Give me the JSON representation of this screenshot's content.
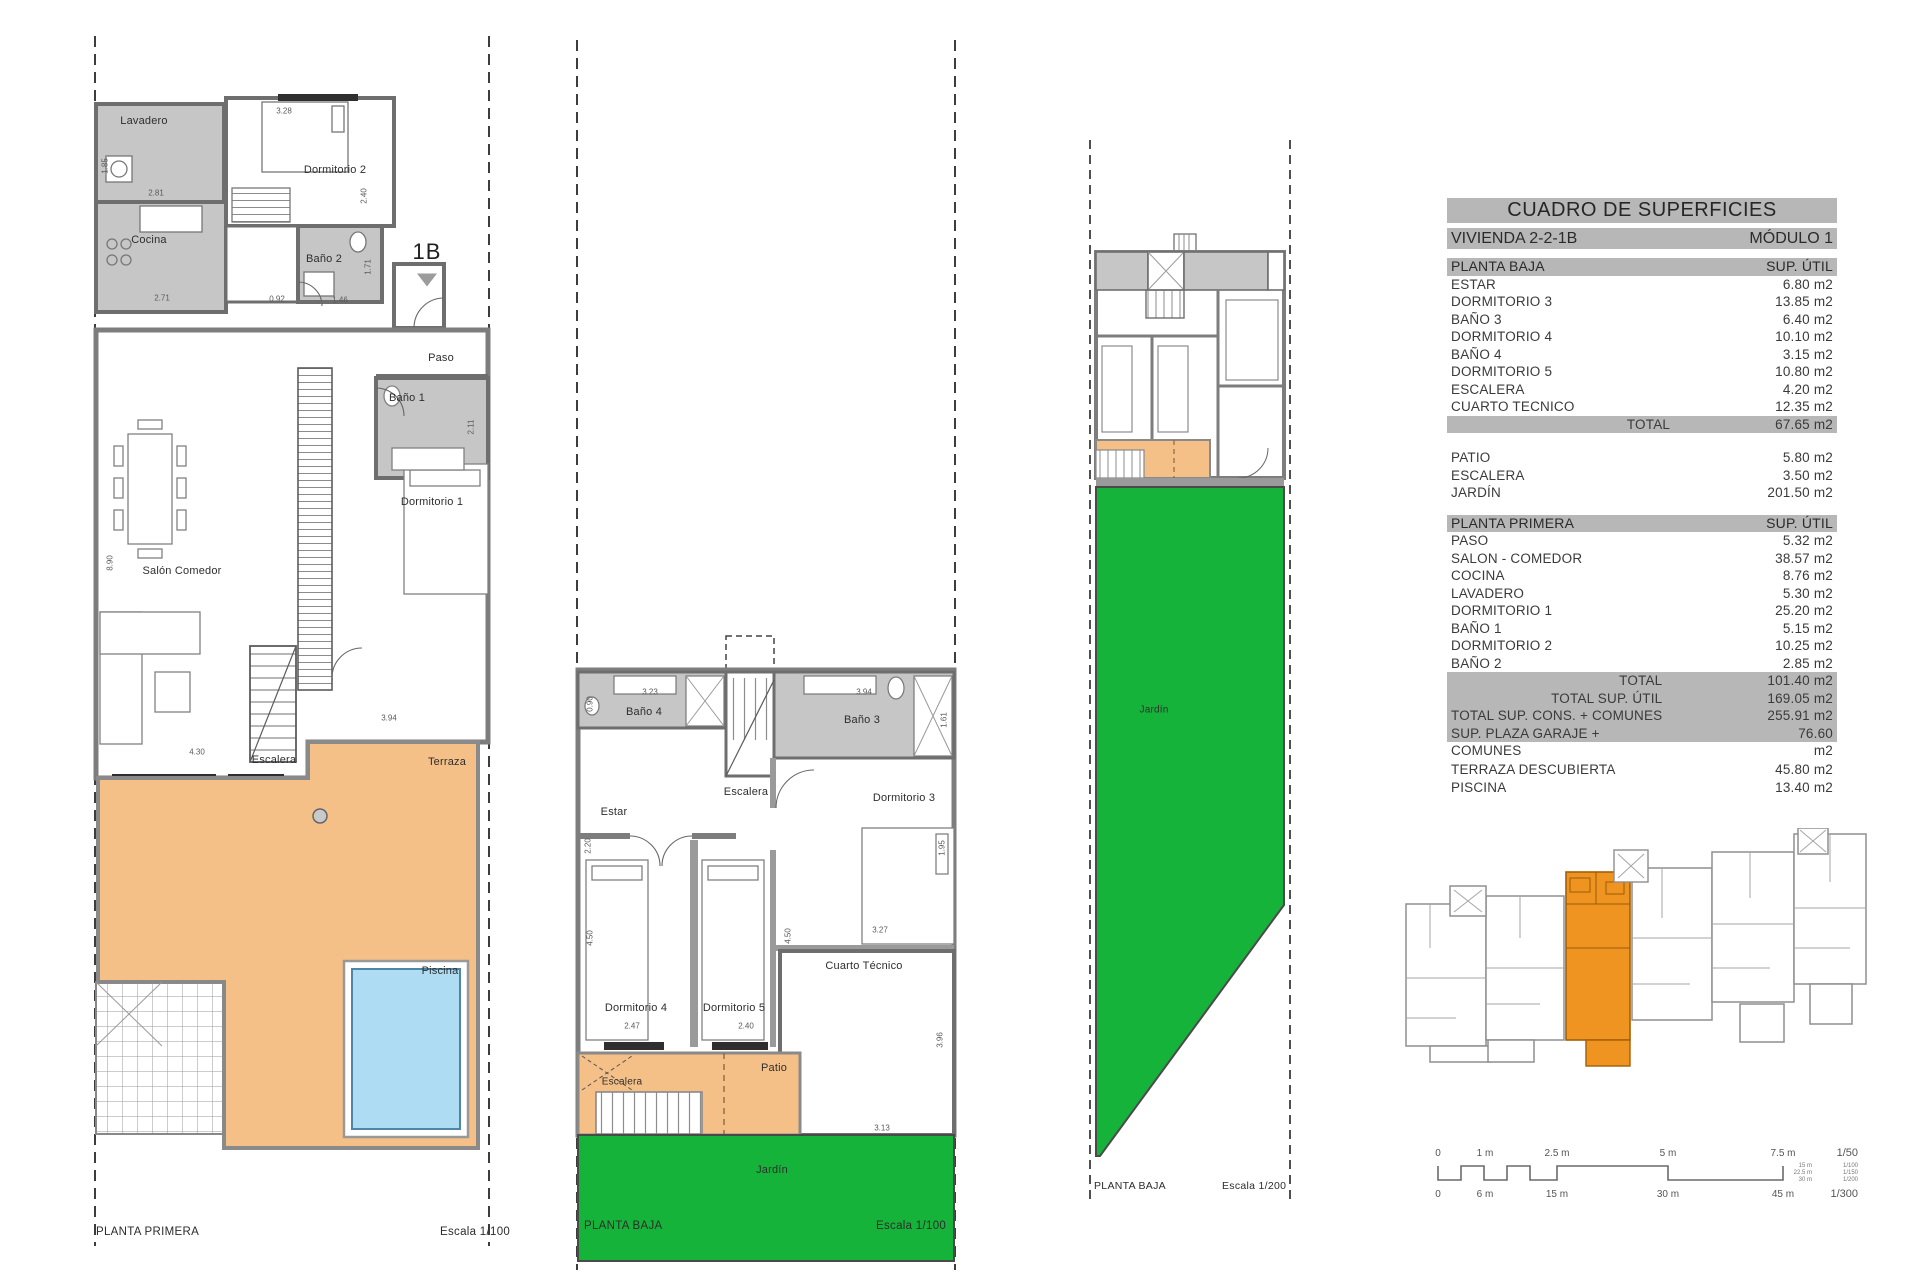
{
  "table": {
    "title": "CUADRO DE SUPERFICIES",
    "vivienda": "VIVIENDA 2-2-1B",
    "modulo": "MÓDULO 1",
    "planta_baja": {
      "header": "PLANTA BAJA",
      "sup_util": "SUP. ÚTIL",
      "rows": [
        {
          "label": "ESTAR",
          "value": "6.80 m2"
        },
        {
          "label": "DORMITORIO 3",
          "value": "13.85 m2"
        },
        {
          "label": "BAÑO 3",
          "value": "6.40 m2"
        },
        {
          "label": "DORMITORIO 4",
          "value": "10.10 m2"
        },
        {
          "label": "BAÑO 4",
          "value": "3.15 m2"
        },
        {
          "label": "DORMITORIO 5",
          "value": "10.80 m2"
        },
        {
          "label": "ESCALERA",
          "value": "4.20 m2"
        },
        {
          "label": "CUARTO TECNICO",
          "value": "12.35 m2"
        }
      ],
      "total_label": "TOTAL",
      "total_value": "67.65 m2"
    },
    "exterior_rows": [
      {
        "label": "PATIO",
        "value": "5.80 m2"
      },
      {
        "label": "ESCALERA",
        "value": "3.50 m2"
      },
      {
        "label": "JARDÍN",
        "value": "201.50 m2"
      }
    ],
    "planta_primera": {
      "header": "PLANTA PRIMERA",
      "sup_util": "SUP. ÚTIL",
      "rows": [
        {
          "label": "PASO",
          "value": "5.32 m2"
        },
        {
          "label": "SALON - COMEDOR",
          "value": "38.57 m2"
        },
        {
          "label": "COCINA",
          "value": "8.76 m2"
        },
        {
          "label": "LAVADERO",
          "value": "5.30 m2"
        },
        {
          "label": "DORMITORIO 1",
          "value": "25.20 m2"
        },
        {
          "label": "BAÑO 1",
          "value": "5.15 m2"
        },
        {
          "label": "DORMITORIO 2",
          "value": "10.25 m2"
        },
        {
          "label": "BAÑO 2",
          "value": "2.85 m2"
        }
      ],
      "totals": [
        {
          "label": "TOTAL",
          "value": "101.40 m2"
        },
        {
          "label": "TOTAL SUP. ÚTIL",
          "value": "169.05 m2"
        },
        {
          "label": "TOTAL SUP. CONS. + COMUNES",
          "value": "255.91 m2"
        },
        {
          "label": "SUP. PLAZA GARAJE + COMUNES",
          "value": "76.60 m2"
        }
      ]
    },
    "extra_rows": [
      {
        "label": "TERRAZA DESCUBIERTA",
        "value": "45.80 m2"
      },
      {
        "label": "PISCINA",
        "value": "13.40 m2"
      }
    ]
  },
  "plan_first_floor": {
    "caption": "PLANTA PRIMERA",
    "scale": "Escala 1/100",
    "marker": "1B",
    "rooms": {
      "lavadero": "Lavadero",
      "cocina": "Cocina",
      "dormitorio2": "Dormitorio 2",
      "bano2": "Baño 2",
      "paso": "Paso",
      "bano1": "Baño 1",
      "dormitorio1": "Dormitorio 1",
      "salon": "Salón Comedor",
      "escalera": "Escalera",
      "terraza": "Terraza",
      "piscina": "Piscina"
    },
    "dims": [
      "3.28",
      "2.40",
      "1.85",
      "2.81",
      "2.71",
      "0.92",
      "1.46",
      "1.71",
      "2.11",
      "8.90",
      "4.30",
      "3.94"
    ]
  },
  "plan_ground_floor": {
    "caption": "PLANTA BAJA",
    "scale": "Escala 1/100",
    "rooms": {
      "bano4": "Baño 4",
      "escalera_top": "Escalera",
      "bano3": "Baño 3",
      "estar": "Estar",
      "dormitorio3": "Dormitorio 3",
      "dormitorio4": "Dormitorio 4",
      "dormitorio5": "Dormitorio 5",
      "cuarto_tecnico": "Cuarto Técnico",
      "patio": "Patio",
      "escalera_bottom": "Escalera",
      "jardin": "Jardín"
    },
    "dims": [
      "3.23",
      "3.94",
      "0.90",
      "1.61",
      "2.20",
      "4.50",
      "1.95",
      "3.27",
      "2.47",
      "2.40",
      "3.96",
      "3.13",
      "4.50"
    ]
  },
  "plan_site": {
    "caption": "PLANTA BAJA",
    "scale": "Escala 1/200",
    "rooms": {
      "jardin": "Jardín"
    }
  },
  "scalebar": {
    "top_ticks": [
      "0",
      "1 m",
      "2.5 m",
      "5 m",
      "7.5 m"
    ],
    "top_scale": "1/50",
    "mid_ticks": [
      "15 m",
      "22.5 m",
      "30 m"
    ],
    "mid_scales": [
      "1/100",
      "1/150",
      "1/200"
    ],
    "bottom_ticks": [
      "0",
      "6 m",
      "15 m",
      "30 m",
      "45 m"
    ],
    "bottom_scale": "1/300"
  },
  "colors": {
    "terrace": "#f5c088",
    "pool": "#addcf3",
    "garden": "#16b33b",
    "site_highlight": "#ef9420",
    "band": "#b7b7b7",
    "wall": "#7d7d7d",
    "wet_room": "#c6c6c6"
  }
}
